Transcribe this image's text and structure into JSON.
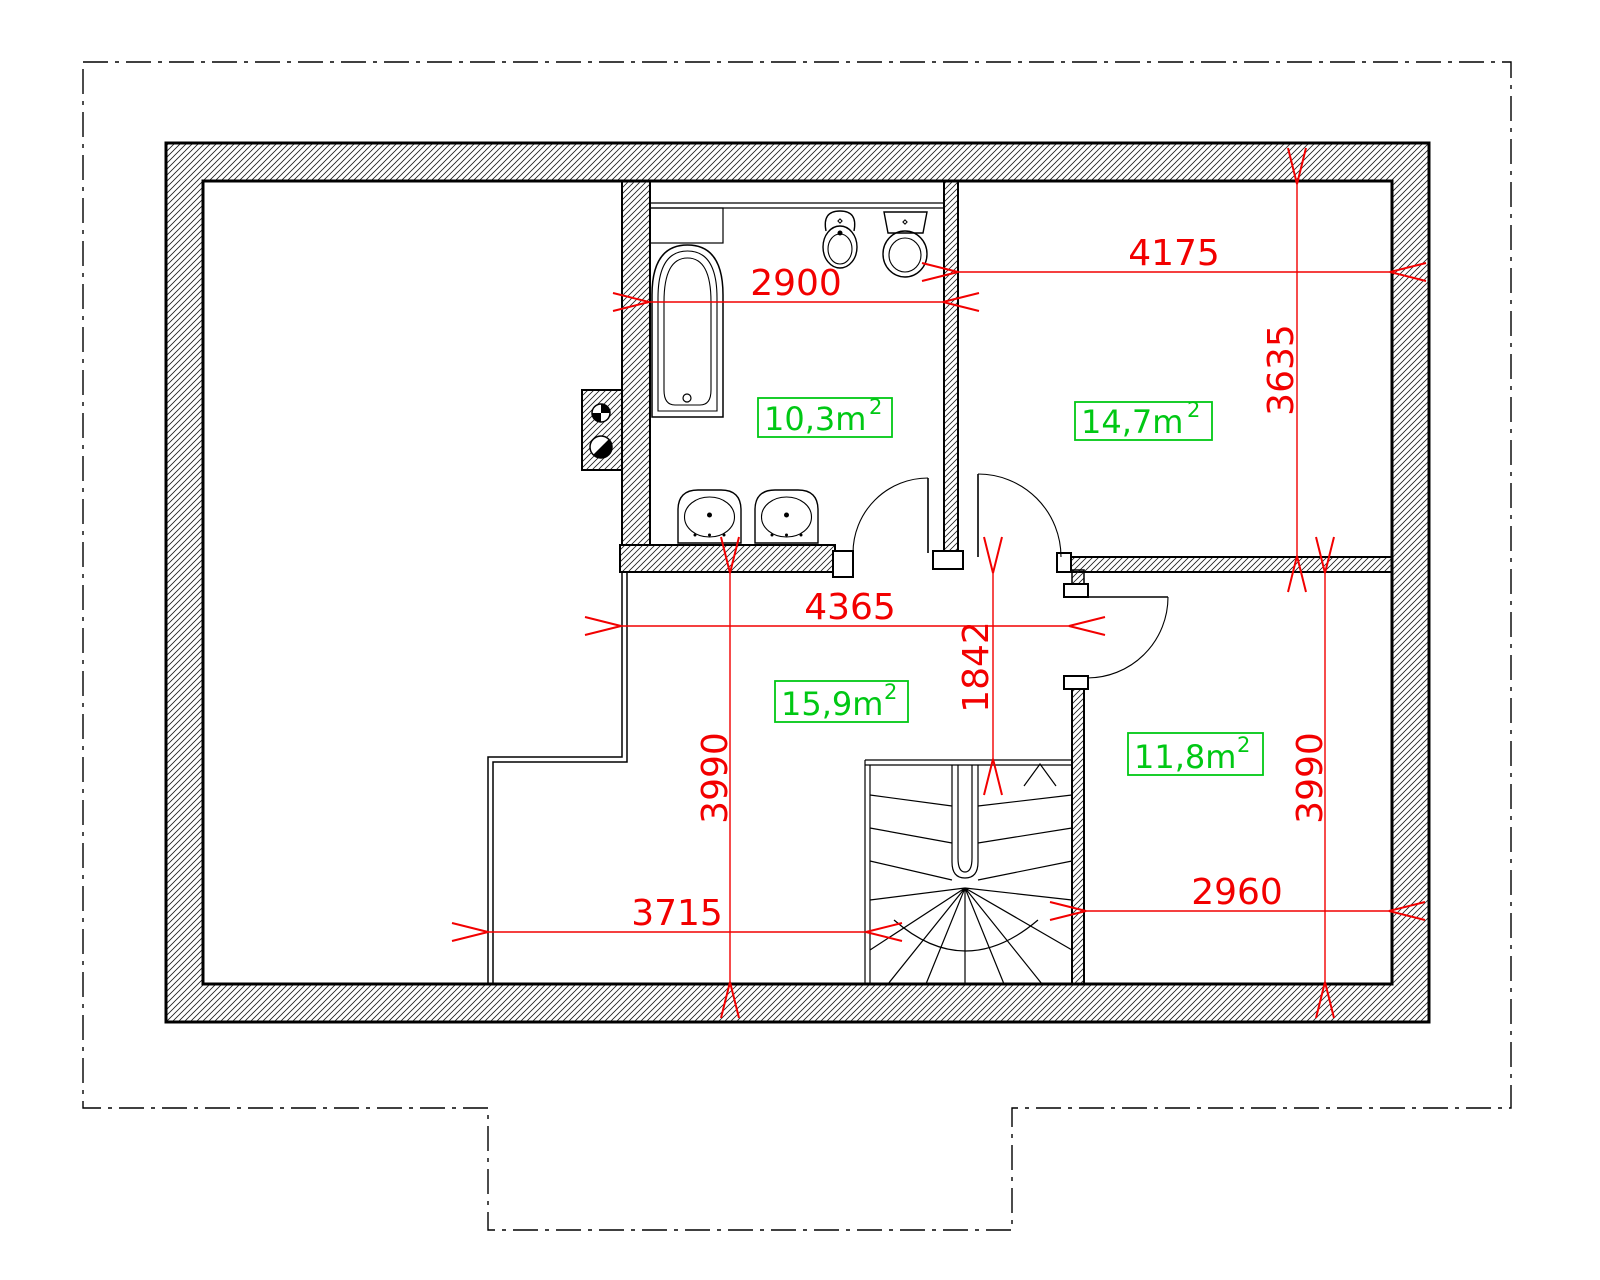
{
  "colors": {
    "dimension_red": "#f20000",
    "area_green": "#00c814",
    "ink": "#000000"
  },
  "dimensions": {
    "bathroom_width": "2900",
    "bedroom_width": "4175",
    "bedroom_depth": "3635",
    "hall_width": "4365",
    "hall_stair_offset": "1842",
    "hall_depth": "3990",
    "hall_lower_width": "3715",
    "right_room_width": "2960",
    "right_room_depth": "3990"
  },
  "rooms": [
    {
      "name": "bathroom",
      "area_label": "10,3m",
      "area_sup": "2"
    },
    {
      "name": "bedroom",
      "area_label": "14,7m",
      "area_sup": "2"
    },
    {
      "name": "hall",
      "area_label": "15,9m",
      "area_sup": "2"
    },
    {
      "name": "right-room",
      "area_label": "11,8m",
      "area_sup": "2"
    }
  ]
}
